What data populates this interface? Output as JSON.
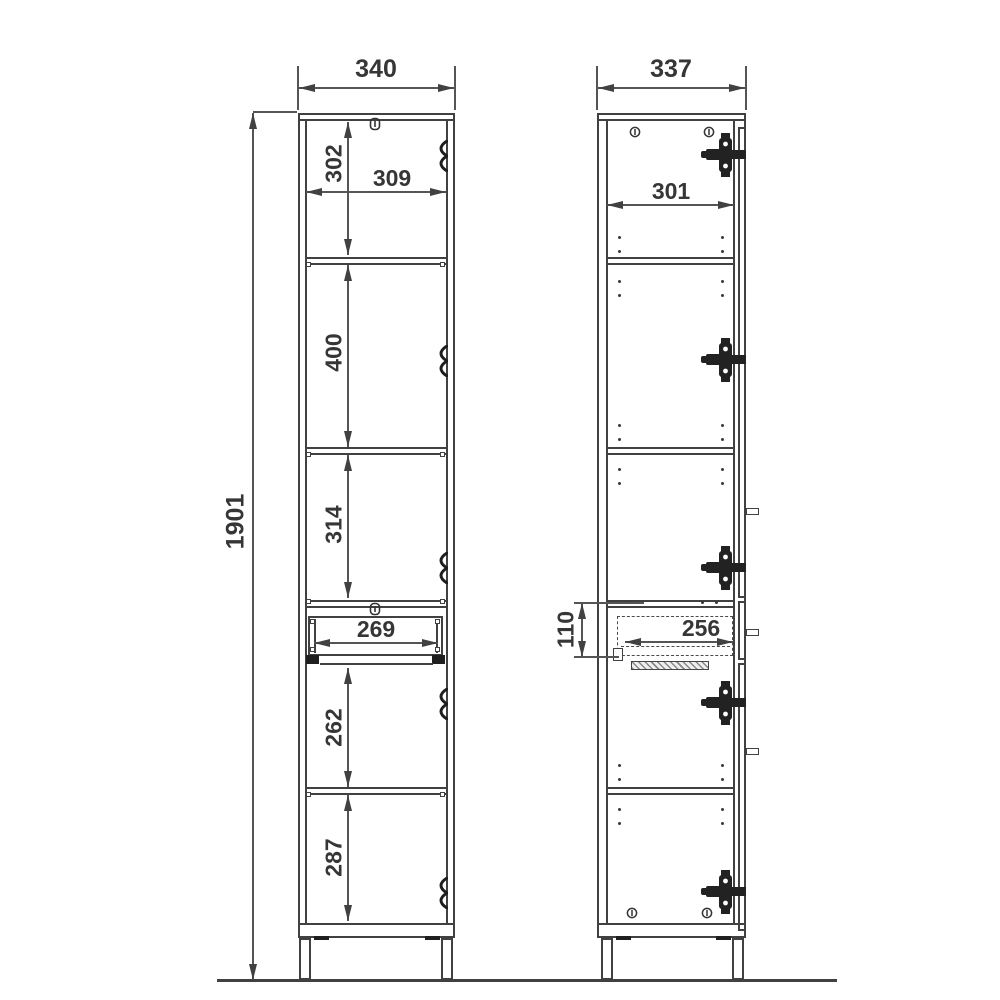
{
  "drawing_title": "tall cabinet technical dimension drawing",
  "colors": {
    "line": "#414141",
    "text": "#363636",
    "background": "#ffffff"
  },
  "front_view": {
    "overall_width": "340",
    "overall_height": "1901",
    "inner_width": "309",
    "section_heights": [
      "302",
      "400",
      "314",
      "262",
      "287"
    ],
    "drawer_inner_width": "269"
  },
  "side_view": {
    "overall_depth": "337",
    "inner_depth": "301",
    "drawer_inner_depth": "256",
    "drawer_front_height": "110"
  },
  "icons": {
    "screw": "cam-screw",
    "hinge": "concealed-hinge",
    "cam_lock": "cam-lock-screw",
    "shelf_pin": "shelf-pin-hole",
    "slide": "drawer-slide-hatch"
  }
}
